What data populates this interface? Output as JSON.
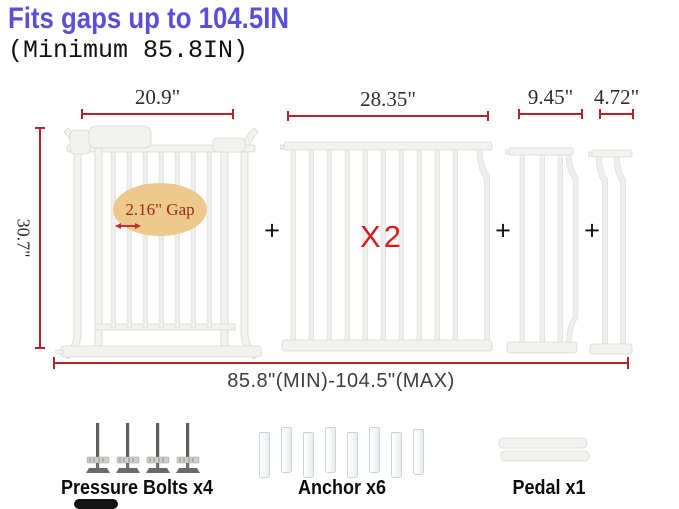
{
  "header": {
    "title": "Fits gaps up to 104.5IN",
    "subtitle": "(Minimum 85.8IN)"
  },
  "diagram": {
    "plus": "+",
    "gate": {
      "width": "20.9\"",
      "height": "30.7\"",
      "gap_note": "2.16\" Gap"
    },
    "extension_large": {
      "width": "28.35\"",
      "qty": "X2"
    },
    "extension_medium": {
      "width": "9.45\""
    },
    "extension_small": {
      "width": "4.72\""
    },
    "total_range": "85.8\"(MIN)-104.5\"(MAX)"
  },
  "parts": {
    "pressure_bolts": {
      "label": "Pressure Bolts x4"
    },
    "anchors": {
      "label": "Anchor x6"
    },
    "pedal": {
      "label": "Pedal x1"
    }
  },
  "colors": {
    "title": "#5a50d8",
    "dimension_line": "#b0262c",
    "qty_red": "#d11f1f",
    "gap_oval_bg": "#edc98e",
    "gap_text": "#9e2a1b"
  }
}
